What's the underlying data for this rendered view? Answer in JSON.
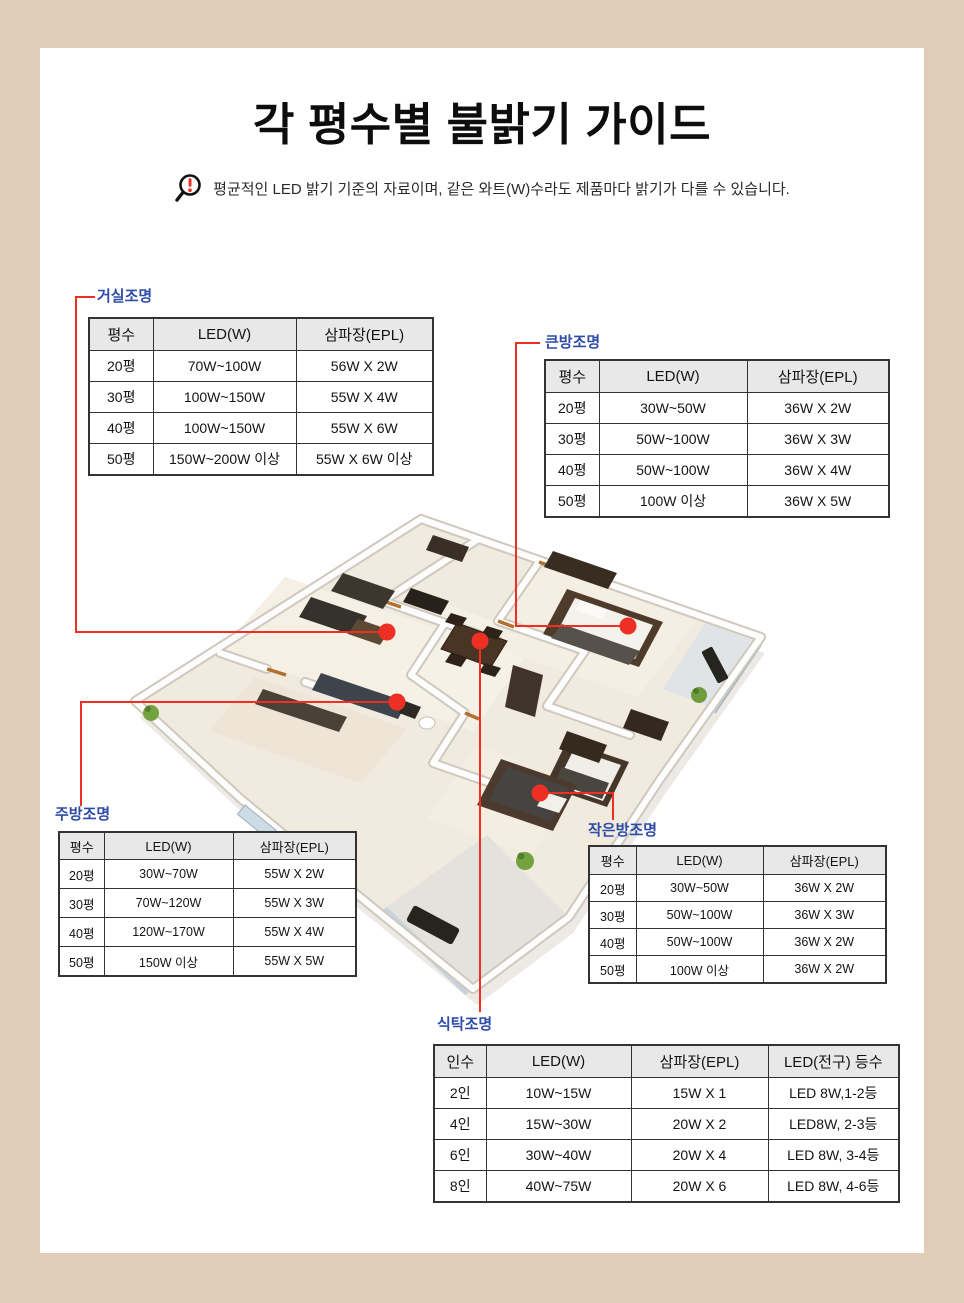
{
  "page": {
    "title": "각 평수별 불밝기 가이드",
    "notice": "평균적인 LED 밝기 기준의 자료이며, 같은 와트(W)수라도 제품마다 밝기가 다를 수 있습니다."
  },
  "colors": {
    "background": "#e1cdb9",
    "panel": "#ffffff",
    "callout_blue": "#2f4da6",
    "accent_red": "#ee2f24",
    "table_border": "#333333",
    "table_header_bg": "#e8e8e8"
  },
  "tables": {
    "living": {
      "label": "거실조명",
      "headers": [
        "평수",
        "LED(W)",
        "삼파장(EPL)"
      ],
      "rows": [
        [
          "20평",
          "70W~100W",
          "56W X 2W"
        ],
        [
          "30평",
          "100W~150W",
          "55W X 4W"
        ],
        [
          "40평",
          "100W~150W",
          "55W X 6W"
        ],
        [
          "50평",
          "150W~200W 이상",
          "55W X 6W 이상"
        ]
      ]
    },
    "bigroom": {
      "label": "큰방조명",
      "headers": [
        "평수",
        "LED(W)",
        "삼파장(EPL)"
      ],
      "rows": [
        [
          "20평",
          "30W~50W",
          "36W X 2W"
        ],
        [
          "30평",
          "50W~100W",
          "36W X 3W"
        ],
        [
          "40평",
          "50W~100W",
          "36W X 4W"
        ],
        [
          "50평",
          "100W 이상",
          "36W X 5W"
        ]
      ]
    },
    "kitchen": {
      "label": "주방조명",
      "headers": [
        "평수",
        "LED(W)",
        "삼파장(EPL)"
      ],
      "rows": [
        [
          "20평",
          "30W~70W",
          "55W X 2W"
        ],
        [
          "30평",
          "70W~120W",
          "55W X 3W"
        ],
        [
          "40평",
          "120W~170W",
          "55W X 4W"
        ],
        [
          "50평",
          "150W 이상",
          "55W X 5W"
        ]
      ]
    },
    "smallroom": {
      "label": "작은방조명",
      "headers": [
        "평수",
        "LED(W)",
        "삼파장(EPL)"
      ],
      "rows": [
        [
          "20평",
          "30W~50W",
          "36W X 2W"
        ],
        [
          "30평",
          "50W~100W",
          "36W X 3W"
        ],
        [
          "40평",
          "50W~100W",
          "36W X 2W"
        ],
        [
          "50평",
          "100W 이상",
          "36W X 2W"
        ]
      ]
    },
    "dining": {
      "label": "식탁조명",
      "headers": [
        "인수",
        "LED(W)",
        "삼파장(EPL)",
        "LED(전구) 등수"
      ],
      "rows": [
        [
          "2인",
          "10W~15W",
          "15W X 1",
          "LED 8W,1-2등"
        ],
        [
          "4인",
          "15W~30W",
          "20W X 2",
          "LED8W, 2-3등"
        ],
        [
          "6인",
          "30W~40W",
          "20W X 4",
          "LED 8W, 3-4등"
        ],
        [
          "8인",
          "40W~75W",
          "20W X 6",
          "LED 8W, 4-6등"
        ]
      ]
    }
  }
}
